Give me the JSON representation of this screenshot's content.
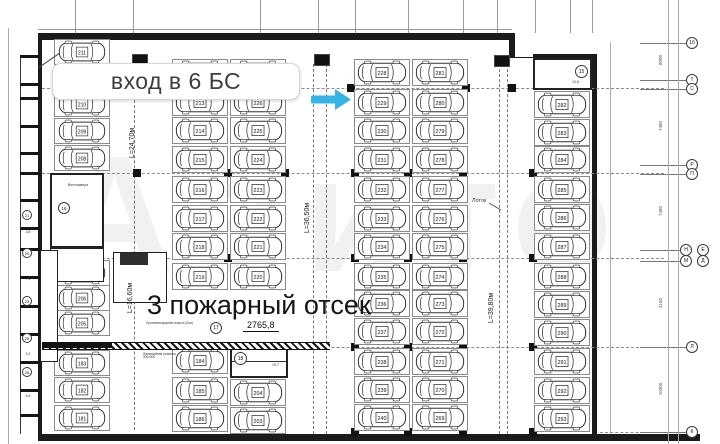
{
  "badge": {
    "text": "вход в 6 БС"
  },
  "labels": {
    "fire_compartment": "3 пожарный отсек",
    "dimension": "2765,8",
    "lotok": "Лоток"
  },
  "watermark": {
    "text": "Авито"
  },
  "arrow": {
    "x": 311,
    "y": 99,
    "color": "#35b4e8"
  },
  "aisle_labels": [
    {
      "text": "L=24,70м",
      "x": 133,
      "y": 143
    },
    {
      "text": "L=36,50м",
      "x": 308,
      "y": 218
    },
    {
      "text": "L=16,60м",
      "x": 131,
      "y": 298
    },
    {
      "text": "L=39,80м",
      "x": 492,
      "y": 308
    }
  ],
  "parking_columns": [
    {
      "name": "col-left",
      "cx": 82,
      "w": 56,
      "h": 26,
      "stalls": [
        [
          211,
          52
        ],
        [
          210,
          104
        ],
        [
          209,
          131
        ],
        [
          208,
          158
        ],
        [
          207,
          273
        ],
        [
          206,
          298
        ],
        [
          205,
          323
        ],
        [
          183,
          363
        ],
        [
          182,
          390
        ],
        [
          181,
          418
        ]
      ]
    },
    {
      "name": "col-b-left",
      "cx": 200,
      "w": 56,
      "h": 27,
      "stalls": [
        [
          212,
          72
        ],
        [
          213,
          102
        ],
        [
          214,
          130
        ],
        [
          215,
          159
        ],
        [
          216,
          189
        ],
        [
          217,
          218
        ],
        [
          218,
          246
        ],
        [
          219,
          276
        ],
        [
          184,
          360
        ],
        [
          185,
          390
        ],
        [
          186,
          418
        ]
      ]
    },
    {
      "name": "col-b-right",
      "cx": 258,
      "w": 56,
      "h": 27,
      "stalls": [
        [
          227,
          72
        ],
        [
          226,
          102
        ],
        [
          225,
          130
        ],
        [
          224,
          159
        ],
        [
          223,
          189
        ],
        [
          222,
          218
        ],
        [
          221,
          246
        ],
        [
          220,
          276
        ],
        [
          204,
          392
        ],
        [
          203,
          420
        ]
      ]
    },
    {
      "name": "col-c-left",
      "cx": 382,
      "w": 56,
      "h": 27,
      "stalls": [
        [
          228,
          72
        ],
        [
          229,
          102
        ],
        [
          230,
          130
        ],
        [
          231,
          159
        ],
        [
          232,
          189
        ],
        [
          233,
          218
        ],
        [
          234,
          246
        ],
        [
          235,
          276
        ],
        [
          236,
          303
        ],
        [
          237,
          331
        ],
        [
          238,
          361
        ],
        [
          239,
          389
        ],
        [
          240,
          417
        ]
      ]
    },
    {
      "name": "col-c-right",
      "cx": 440,
      "w": 56,
      "h": 27,
      "stalls": [
        [
          281,
          72
        ],
        [
          280,
          102
        ],
        [
          279,
          130
        ],
        [
          278,
          159
        ],
        [
          277,
          189
        ],
        [
          276,
          218
        ],
        [
          275,
          246
        ],
        [
          274,
          276
        ],
        [
          273,
          303
        ],
        [
          272,
          331
        ],
        [
          271,
          361
        ],
        [
          270,
          389
        ],
        [
          269,
          417
        ]
      ]
    },
    {
      "name": "col-right",
      "cx": 562,
      "w": 56,
      "h": 27,
      "stalls": [
        [
          282,
          104
        ],
        [
          283,
          132
        ],
        [
          284,
          159
        ],
        [
          285,
          189
        ],
        [
          286,
          217
        ],
        [
          287,
          246
        ],
        [
          288,
          276
        ],
        [
          289,
          304
        ],
        [
          290,
          332
        ],
        [
          291,
          361
        ],
        [
          292,
          390
        ],
        [
          293,
          418
        ]
      ]
    }
  ],
  "rooms": {
    "vent": {
      "label": "Венткамера",
      "num": "16"
    },
    "stair_top_right": {
      "num": "15",
      "area": "10,6"
    },
    "stair_bottom_center": {
      "num": "18",
      "area": "19,7"
    }
  },
  "compartment_circle": {
    "num": "17",
    "x": 216,
    "y": 328
  },
  "grid_circles": [
    {
      "label": "1б",
      "x": 692,
      "y": 43
    },
    {
      "label": "Т",
      "x": 692,
      "y": 80
    },
    {
      "label": "С",
      "x": 692,
      "y": 89
    },
    {
      "label": "Р",
      "x": 692,
      "y": 165
    },
    {
      "label": "П",
      "x": 692,
      "y": 174
    },
    {
      "label": "Н",
      "x": 686,
      "y": 250
    },
    {
      "label": "Е",
      "x": 703,
      "y": 250
    },
    {
      "label": "М",
      "x": 686,
      "y": 261
    },
    {
      "label": "Д",
      "x": 703,
      "y": 261
    },
    {
      "label": "Л",
      "x": 692,
      "y": 347
    },
    {
      "label": "К",
      "x": 692,
      "y": 432
    }
  ],
  "right_dims": [
    {
      "text": "8000",
      "y": 60
    },
    {
      "text": "7480",
      "y": 126
    },
    {
      "text": "7480",
      "y": 211
    },
    {
      "text": "4160",
      "y": 303
    },
    {
      "text": "10300",
      "y": 389
    }
  ],
  "left_cells": {
    "separators": [
      55,
      83,
      97,
      125,
      152,
      172,
      199,
      227,
      248,
      276,
      305,
      333,
      361,
      389,
      414
    ],
    "circles": [
      [
        "21",
        215
      ],
      [
        "20",
        253
      ],
      [
        "23",
        301
      ],
      [
        "25",
        338
      ],
      [
        "26",
        372
      ]
    ],
    "areas": [
      [
        "3,8",
        233
      ],
      [
        "7,6",
        280
      ],
      [
        "5,2",
        355
      ],
      [
        "6,6",
        397
      ]
    ]
  },
  "notes": [
    {
      "text": "Противопожарные ворота (2шт)",
      "x": 146,
      "y": 322,
      "w": 48
    },
    {
      "text": "Жалюзийная решетка 300х300",
      "x": 143,
      "y": 353,
      "w": 42
    }
  ],
  "lotok_pos": {
    "x": 472,
    "y": 199
  },
  "column_squares": {
    "88": [
      137,
      287,
      351,
      466,
      512
    ],
    "173": [
      137,
      228,
      285,
      355,
      408,
      463,
      533
    ],
    "258": [
      228,
      355,
      408,
      463,
      533
    ],
    "347": [
      355,
      408,
      463,
      533
    ],
    "432": [
      355,
      408,
      463,
      533
    ]
  },
  "vent_markers": [
    [
      139,
      59
    ],
    [
      321,
      59
    ],
    [
      501,
      60
    ]
  ],
  "grid_geometry": {
    "h_lines": [
      [
        88,
        42,
        664
      ],
      [
        173,
        42,
        664
      ],
      [
        258,
        42,
        664
      ],
      [
        347,
        42,
        664
      ],
      [
        432,
        600,
        664
      ]
    ],
    "circle_stub_ys": [
      43,
      80,
      89,
      165,
      174,
      250,
      261,
      347,
      432
    ],
    "v_stubs_top": [
      75,
      133,
      260,
      318,
      355,
      408,
      463,
      497,
      535,
      570,
      592
    ],
    "v_lines": [
      [
        668,
        0,
        444
      ],
      [
        678,
        0,
        444
      ],
      [
        610,
        42,
        434
      ],
      [
        8,
        28,
        444
      ]
    ],
    "ramp_dashes": [
      [
        313,
        64,
        434
      ],
      [
        326,
        64,
        434
      ],
      [
        499,
        64,
        434
      ],
      [
        507,
        64,
        434
      ],
      [
        134,
        95,
        430
      ]
    ]
  },
  "walls": [
    [
      38,
      33,
      477,
      7
    ],
    [
      509,
      40,
      6,
      18
    ],
    [
      38,
      33,
      4,
      408
    ],
    [
      38,
      434,
      662,
      7
    ],
    [
      592,
      58,
      5,
      383
    ],
    [
      533,
      54,
      64,
      4
    ],
    [
      512,
      57,
      23,
      1
    ]
  ]
}
